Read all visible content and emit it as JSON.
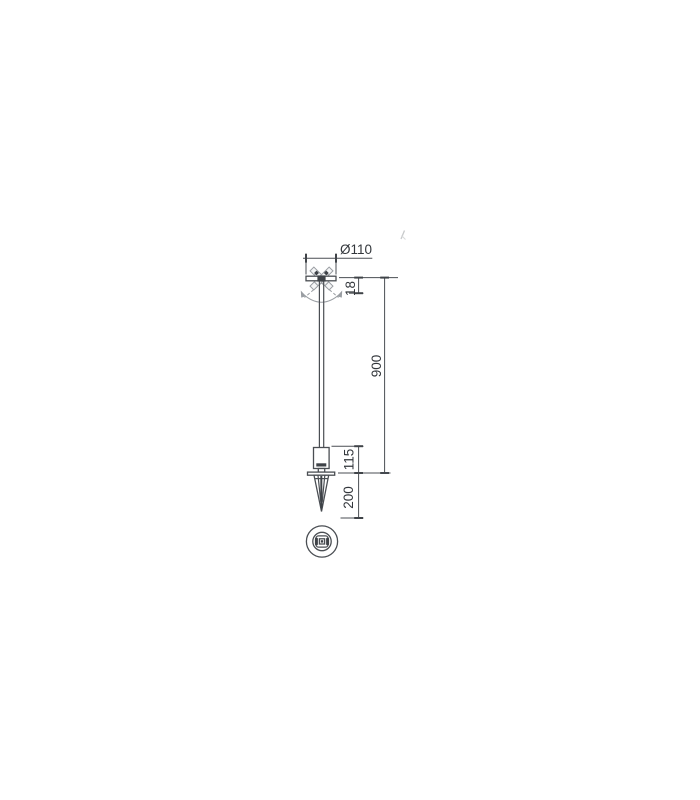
{
  "page": {
    "background_color": "#ffffff"
  },
  "drawing": {
    "type": "technical-dimension-drawing",
    "colors": {
      "line": "#4a4e53",
      "ghost": "#999da2",
      "text": "#33373c",
      "background": "#ffffff"
    },
    "dimensions": {
      "head_diameter": {
        "label": "Ø110",
        "orientation": "horizontal"
      },
      "head_height": {
        "label": "18",
        "orientation": "vertical"
      },
      "overall_height": {
        "label": "900",
        "orientation": "vertical"
      },
      "body_height": {
        "label": "115",
        "orientation": "vertical"
      },
      "spike_depth": {
        "label": "200",
        "orientation": "vertical"
      }
    }
  }
}
